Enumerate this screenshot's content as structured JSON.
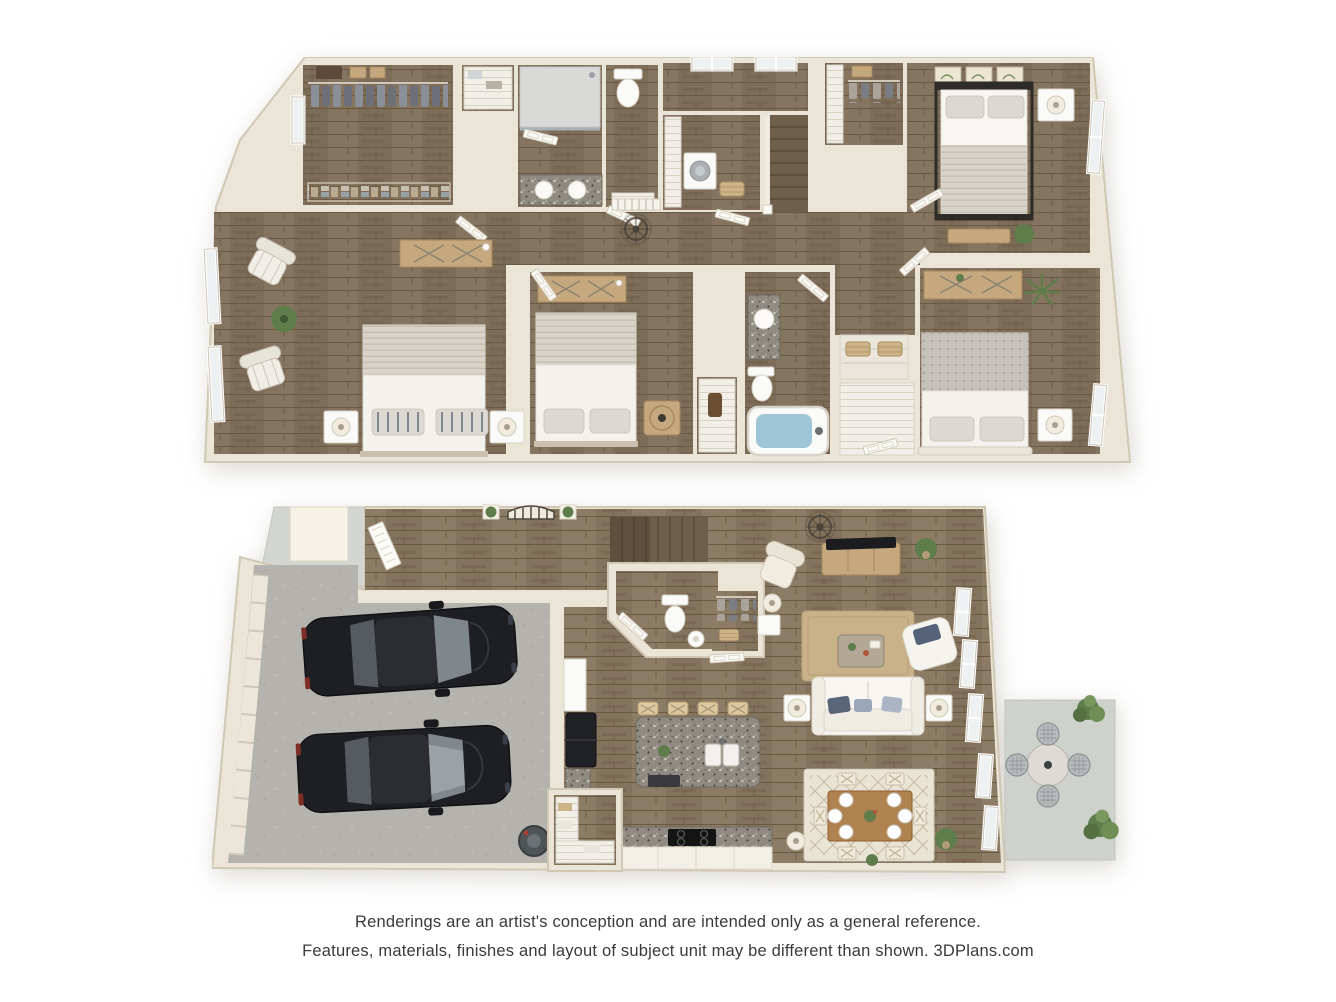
{
  "disclaimer": {
    "line1": "Renderings are an artist's conception and are intended only as a general reference.",
    "line2": "Features, materials, finishes and layout of subject unit may be different than shown. 3DPlans.com"
  },
  "branding": "3DPlans.com",
  "palette": {
    "background": "#ffffff",
    "wall": "#ebe5d7",
    "wall_shadow": "#d0c8b5",
    "wood_upper": "#7d6c58",
    "wood_lower": "#84735c",
    "concrete_garage": "#b5b3ad",
    "concrete_patio": "#cfd1cd",
    "tub_water": "#9ec5d5",
    "granite": "#8f8a82",
    "car_body": "#1e1f22",
    "car_glass": "#8b9399",
    "greenery": "#5f7d4b",
    "rug_jute": "#c9b28a",
    "rug_cream": "#eae4d4",
    "table_wood": "#b0824f",
    "furniture_wood": "#c6a87e",
    "fixture_white": "#fafaf8",
    "text": "#3a3a3a"
  },
  "floors": [
    {
      "label": "second floor",
      "rooms": [
        {
          "name": "owner-bedroom",
          "furniture": [
            "bed with striped pillows",
            "2 nightstands",
            "2 table lamps",
            "dresser desk",
            "2 striped accent chairs",
            "potted plant",
            "2 windows"
          ]
        },
        {
          "name": "owner-walk-in-closet",
          "furniture": [
            "hanging rod with clothes",
            "shelf boxes",
            "folded linen shelf",
            "window"
          ]
        },
        {
          "name": "owner-bathroom",
          "furniture": [
            "walk-in shower",
            "double-sink granite vanity",
            "private toilet room",
            "slat shelf"
          ]
        },
        {
          "name": "linen-closet",
          "furniture": [
            "shelves with towels"
          ]
        },
        {
          "name": "laundry-room",
          "furniture": [
            "washer",
            "storage shelving",
            "laundry basket"
          ]
        },
        {
          "name": "hallway",
          "furniture": [
            "stair guard railing",
            "ceiling fan medallion"
          ]
        },
        {
          "name": "staircase",
          "furniture": [
            "wood treads"
          ]
        },
        {
          "name": "walk-in-closet-2",
          "furniture": [
            "hanging rod",
            "slat shelving",
            "boxes"
          ]
        },
        {
          "name": "bedroom-2",
          "furniture": [
            "black metal frame bed",
            "nightstand with lamp",
            "bench",
            "3 botanical prints",
            "plant",
            "window"
          ]
        },
        {
          "name": "bedroom-3",
          "furniture": [
            "bed",
            "dresser",
            "round-front nightstand"
          ]
        },
        {
          "name": "hall-bathroom",
          "furniture": [
            "bathtub with water",
            "toilet",
            "granite vanity sink"
          ]
        },
        {
          "name": "linen-storage",
          "furniture": [
            "wire shelves",
            "2 baskets",
            "slat shelf closet with door"
          ]
        },
        {
          "name": "bedroom-4",
          "furniture": [
            "bed with patterned blanket",
            "dresser with plant",
            "palm plant",
            "nightstand with lamp",
            "window"
          ]
        }
      ]
    },
    {
      "label": "first floor",
      "rooms": [
        {
          "name": "two-car-garage",
          "furniture": [
            "2 dark sedans",
            "paneled garage door",
            "water heater"
          ]
        },
        {
          "name": "entry-foyer",
          "furniture": [
            "glazed front door",
            "arched gate decor",
            "2 wall plants"
          ]
        },
        {
          "name": "front-porch",
          "furniture": [
            "column",
            "concrete walkway"
          ]
        },
        {
          "name": "staircase",
          "furniture": [
            "wood treads",
            "dark handrail"
          ]
        },
        {
          "name": "powder-room",
          "furniture": [
            "toilet",
            "pedestal sink",
            "angled door"
          ]
        },
        {
          "name": "coat-closet",
          "furniture": [
            "hanging rod with clothes",
            "basket"
          ]
        },
        {
          "name": "kitchen",
          "furniture": [
            "granite island",
            "double sink",
            "dishwasher",
            "4 cross-back bar stools",
            "black refrigerator",
            "cooktop range",
            "granite counters",
            "walk-in pantry shelving"
          ]
        },
        {
          "name": "dining-area",
          "furniture": [
            "wood table",
            "6 place settings",
            "6 cross-back chairs",
            "diamond patterned rug",
            "potted plant",
            "floor lamp"
          ]
        },
        {
          "name": "living-room",
          "furniture": [
            "white sofa with blue pillows",
            "2 end tables with lamps",
            "accent chair",
            "wingback chair",
            "floor lamp",
            "coffee table",
            "TV console with television",
            "jute rug",
            "ceiling fan medallion",
            "potted plant",
            "5 tall windows"
          ]
        },
        {
          "name": "patio",
          "furniture": [
            "round stone table",
            "4 mesh chairs",
            "2 shrubs"
          ]
        }
      ]
    }
  ]
}
